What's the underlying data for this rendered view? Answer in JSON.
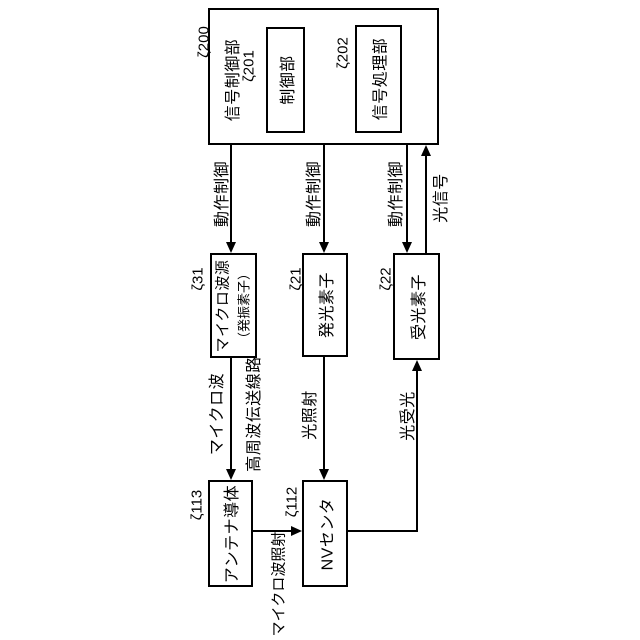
{
  "colors": {
    "line": "#000000",
    "background": "#ffffff",
    "text": "#000000"
  },
  "boxes": {
    "signal_control_unit": {
      "label": "信号制御部",
      "ref": "ζ200"
    },
    "control_unit": {
      "label": "制御部",
      "ref": "ζ201"
    },
    "signal_processing_unit": {
      "label": "信号処理部",
      "ref": "ζ202"
    },
    "microwave_source": {
      "label_line1": "マイクロ波源",
      "label_line2": "（発振素子）",
      "ref": "ζ31"
    },
    "light_emitting_element": {
      "label": "発光素子",
      "ref": "ζ21"
    },
    "light_receiving_element": {
      "label": "受光素子",
      "ref": "ζ22"
    },
    "antenna_conductor": {
      "label": "アンテナ導体",
      "ref": "ζ113"
    },
    "nv_center": {
      "label": "NVセンタ",
      "ref": "ζ112"
    }
  },
  "arrow_labels": {
    "operation_control_1": "動作制御",
    "operation_control_2": "動作制御",
    "operation_control_3": "動作制御",
    "optical_signal": "光信号",
    "microwave": "マイクロ波",
    "high_frequency_transmission_line": "高周波伝送線路",
    "light_irradiation": "光照射",
    "light_reception": "光受光",
    "microwave_irradiation": "マイクロ波照射"
  }
}
